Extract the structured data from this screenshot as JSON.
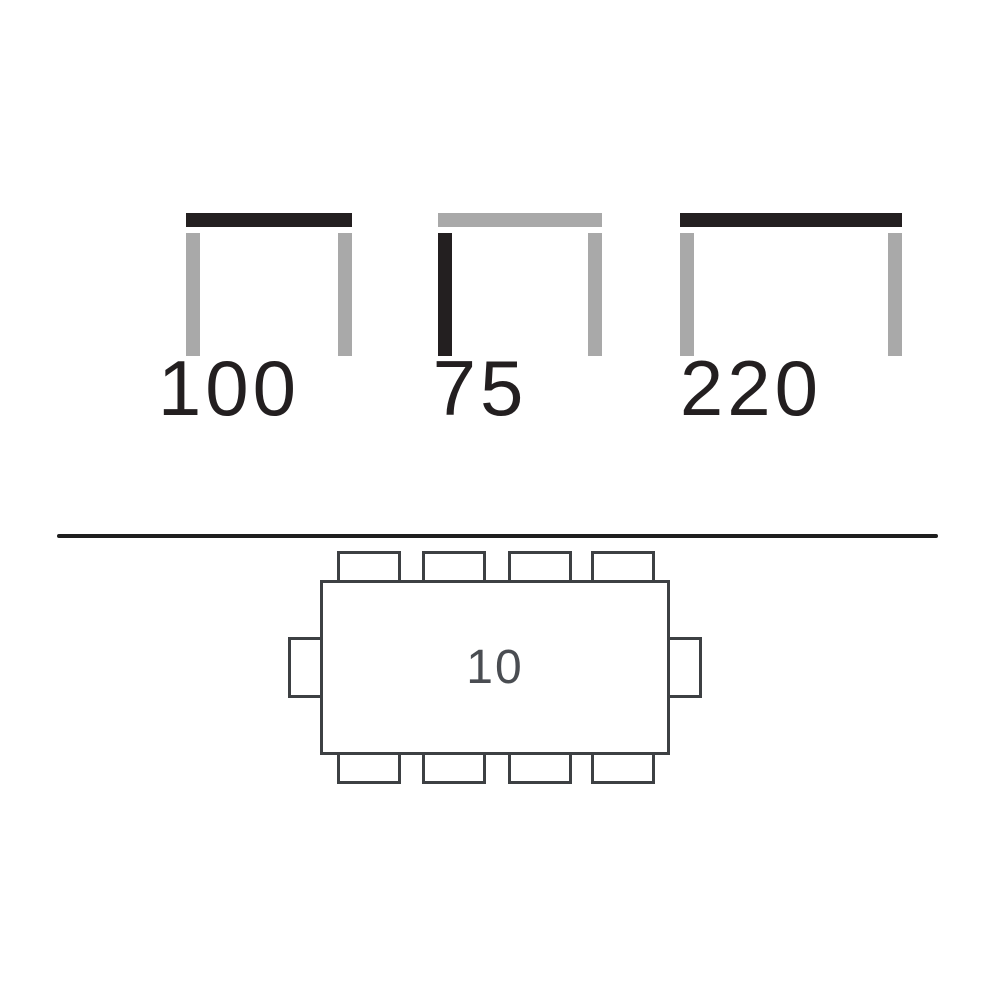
{
  "colors": {
    "dark": "#231f20",
    "gray": "#a9a9a9",
    "line": "#3d4043",
    "label": "#4a4d52",
    "divider": "#1e1e1e",
    "background": "#ffffff"
  },
  "side_views": {
    "items": [
      {
        "value": "100",
        "top": "dark",
        "left_leg": "gray",
        "right_leg": "gray"
      },
      {
        "value": "75",
        "top": "gray",
        "left_leg": "dark",
        "right_leg": "gray"
      },
      {
        "value": "220",
        "top": "dark",
        "left_leg": "gray",
        "right_leg": "gray"
      }
    ]
  },
  "seating_plan": {
    "capacity": "10",
    "chairs_top": 4,
    "chairs_bottom": 4,
    "chairs_left": 1,
    "chairs_right": 1,
    "total_chairs": 10
  }
}
